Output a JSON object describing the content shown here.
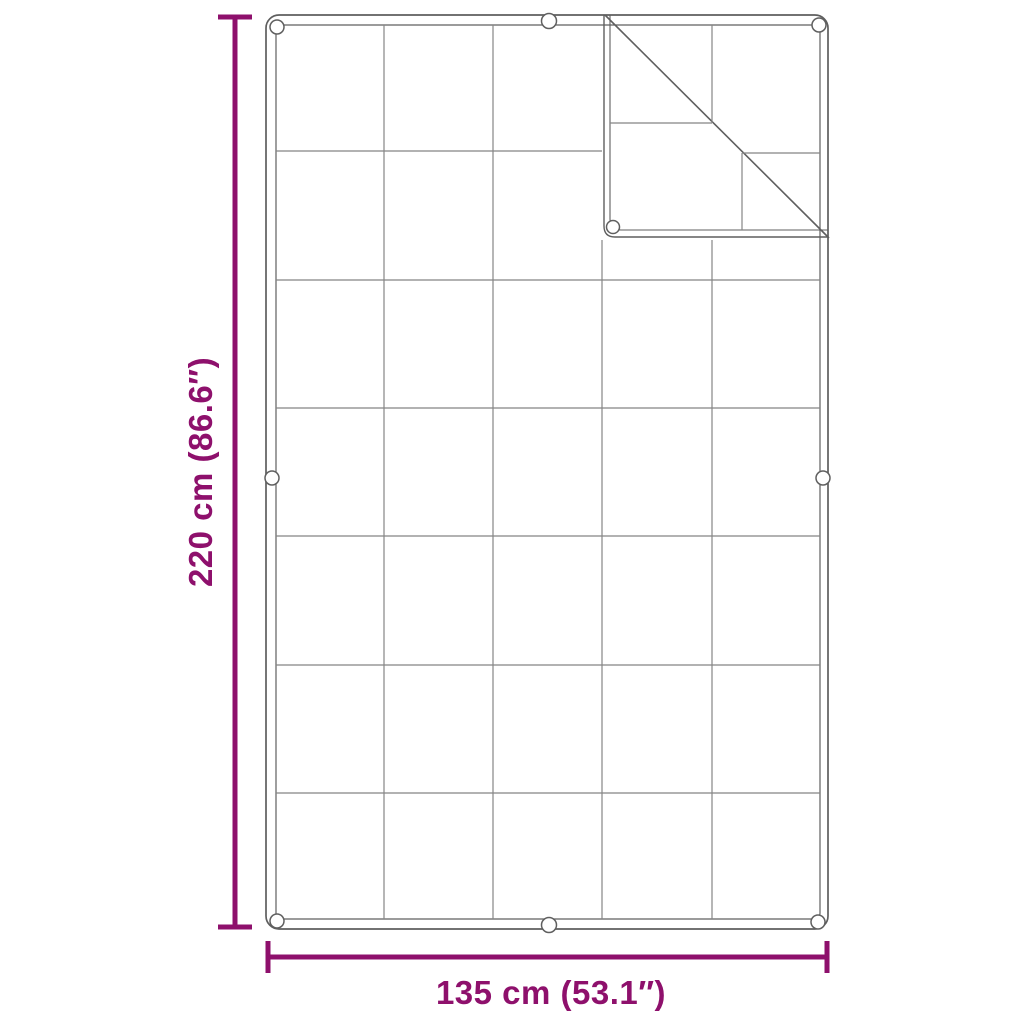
{
  "figure": {
    "type": "product-dimension-diagram",
    "subject": "gridded tarp / groundsheet with folded-over top-right corner",
    "grid": {
      "columns": 5,
      "rows": 7
    },
    "grommet_count": 9,
    "folded_corner": "top-right"
  },
  "colors": {
    "dimension_accent": "#8E106C",
    "outline_gray": "#5f5f5f",
    "grid_gray": "#858585",
    "background": "#ffffff"
  },
  "dimension_labels": {
    "height": "220 cm (86.6″)",
    "width": "135 cm (53.1″)"
  }
}
